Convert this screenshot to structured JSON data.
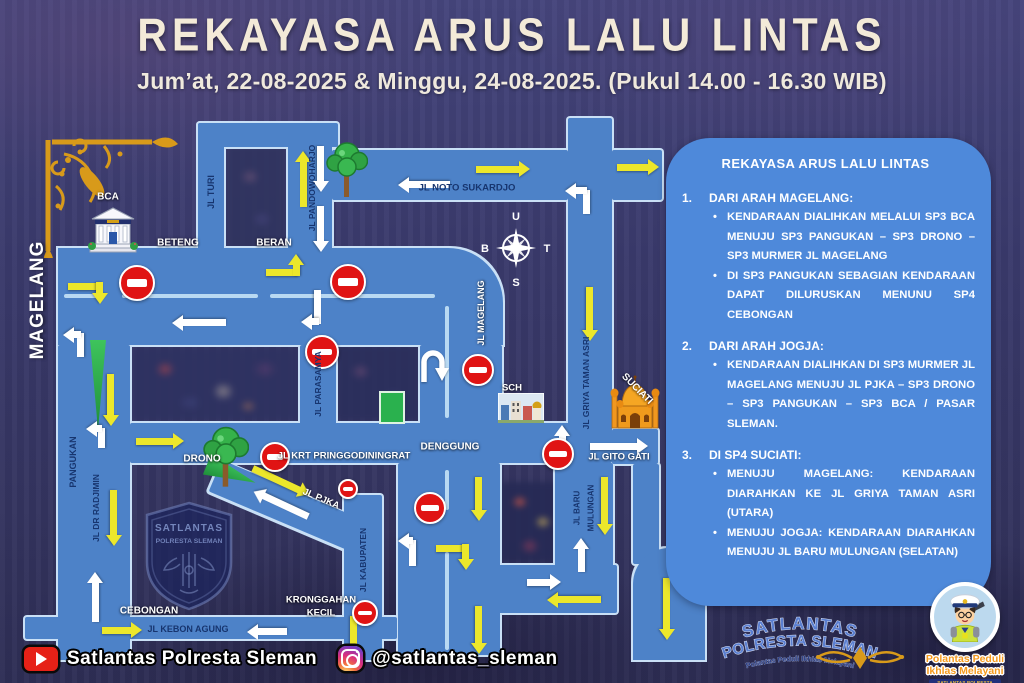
{
  "header": {
    "title": "REKAYASA ARUS LALU LINTAS",
    "subtitle": "Jum’at, 22-08-2025 & Minggu, 24-08-2025. (Pukul 14.00 - 16.30 WIB)"
  },
  "panel": {
    "title": "REKAYASA ARUS LALU LINTAS",
    "sections": [
      {
        "number": "1.",
        "heading": "DARI ARAH MAGELANG:",
        "bullets": [
          "KENDARAAN DIALIHKAN MELALUI SP3 BCA MENUJU SP3 PANGUKAN – SP3 DRONO – SP3 MURMER JL MAGELANG",
          "DI SP3 PANGUKAN SEBAGIAN KENDARAAN DAPAT DILURUSKAN MENUNU SP4 CEBONGAN"
        ]
      },
      {
        "number": "2.",
        "heading": "DARI ARAH JOGJA:",
        "bullets": [
          "KENDARAAN DIALIHKAN DI SP3 MURMER JL MAGELANG MENUJU JL PJKA – SP3 DRONO – SP3 PANGUKAN – SP3 BCA / PASAR SLEMAN."
        ]
      },
      {
        "number": "3.",
        "heading": "DI SP4 SUCIATI:",
        "bullets": [
          "MENUJU MAGELANG: KENDARAAN DIARAHKAN KE JL GRIYA TAMAN ASRI (UTARA)",
          "MENUJU JOGJA: KENDARAAN DIARAHKAN MENUJU JL BARU MULUNGAN (SELATAN)"
        ]
      }
    ]
  },
  "footer": {
    "youtube_label": "Satlantas Polresta Sleman",
    "instagram_label": "@satlantas_sleman"
  },
  "logos": {
    "arc_line1": "SATLANTAS",
    "arc_line2": "POLRESTA SLEMAN",
    "arc_tagline": "Polantas Peduli Ikhlas Melayani",
    "mascot_line1": "Polantas Peduli",
    "mascot_line2": "Ikhlas Melayani",
    "mascot_ribbon": "SATLANTAS POLRESTA SLEMAN"
  },
  "watermark": {
    "line1": "SATLANTAS",
    "line2": "POLRESTA SLEMAN"
  },
  "colors": {
    "road": "#4d82c8",
    "road_outline": "#c9e0f6",
    "panel": "#4e89da",
    "arrow_yellow": "#ece72b",
    "arrow_white": "#ffffff",
    "no_entry_red": "#e01414",
    "title_cream": "#f3ead8",
    "gold": "#d89a1a"
  },
  "compass": {
    "north": "U",
    "east": "T",
    "south": "S",
    "west": "B"
  },
  "map": {
    "landmarks": [
      "gold-corner-ornament",
      "bca-bank-building",
      "tree",
      "compass-rose",
      "school-building",
      "suciati-mosque",
      "satlantas-shield-watermark",
      "u-turn-arrow",
      "green-median-wedge",
      "green-field"
    ],
    "roads": [
      {
        "x": 198,
        "y": 123,
        "w": 140,
        "h": 24
      },
      {
        "x": 198,
        "y": 123,
        "w": 26,
        "h": 132
      },
      {
        "x": 288,
        "y": 123,
        "w": 44,
        "h": 130
      },
      {
        "x": 332,
        "y": 150,
        "w": 236,
        "h": 50
      },
      {
        "x": 612,
        "y": 150,
        "w": 50,
        "h": 50
      },
      {
        "x": 568,
        "y": 118,
        "w": 44,
        "h": 315
      },
      {
        "x": 58,
        "y": 248,
        "w": 445,
        "h": 97,
        "br": "0 55px 0 0"
      },
      {
        "x": 58,
        "y": 345,
        "w": 72,
        "h": 315
      },
      {
        "x": 130,
        "y": 423,
        "w": 482,
        "h": 40
      },
      {
        "x": 300,
        "y": 345,
        "w": 36,
        "h": 80
      },
      {
        "x": 420,
        "y": 345,
        "w": 82,
        "h": 80
      },
      {
        "x": 398,
        "y": 463,
        "w": 102,
        "h": 192
      },
      {
        "x": 222,
        "y": 460,
        "w": 168,
        "h": 34,
        "r": 23
      },
      {
        "x": 344,
        "y": 495,
        "w": 38,
        "h": 165
      },
      {
        "x": 555,
        "y": 463,
        "w": 58,
        "h": 114
      },
      {
        "x": 484,
        "y": 565,
        "w": 133,
        "h": 48
      },
      {
        "x": 612,
        "y": 429,
        "w": 46,
        "h": 35
      },
      {
        "x": 633,
        "y": 464,
        "w": 26,
        "h": 100
      },
      {
        "x": 633,
        "y": 548,
        "w": 72,
        "h": 112,
        "br": "36px 36px 0 0"
      },
      {
        "x": 25,
        "y": 617,
        "w": 372,
        "h": 22
      }
    ],
    "dividers": [
      {
        "x": 64,
        "y": 294,
        "l": 34,
        "o": "h"
      },
      {
        "x": 122,
        "y": 294,
        "l": 136,
        "o": "h"
      },
      {
        "x": 270,
        "y": 294,
        "l": 165,
        "o": "h"
      },
      {
        "x": 445,
        "y": 306,
        "l": 112,
        "o": "v"
      },
      {
        "x": 445,
        "y": 470,
        "l": 40,
        "o": "v"
      },
      {
        "x": 445,
        "y": 552,
        "l": 98,
        "o": "v"
      }
    ],
    "no_entry_signs": [
      {
        "x": 135,
        "y": 281,
        "r": 16
      },
      {
        "x": 346,
        "y": 280,
        "r": 16
      },
      {
        "x": 320,
        "y": 350,
        "r": 15
      },
      {
        "x": 476,
        "y": 368,
        "r": 14
      },
      {
        "x": 556,
        "y": 452,
        "r": 14
      },
      {
        "x": 273,
        "y": 455,
        "r": 13
      },
      {
        "x": 346,
        "y": 487,
        "r": 8
      },
      {
        "x": 428,
        "y": 506,
        "r": 14
      },
      {
        "x": 363,
        "y": 611,
        "r": 11
      }
    ],
    "arrows": [
      {
        "x": 303,
        "y": 207,
        "l": 56,
        "a": -90,
        "c": "y"
      },
      {
        "x": 476,
        "y": 169,
        "l": 54,
        "a": 0,
        "c": "y"
      },
      {
        "x": 617,
        "y": 167,
        "l": 42,
        "a": 0,
        "c": "y"
      },
      {
        "x": 590,
        "y": 287,
        "l": 54,
        "a": 90,
        "c": "y"
      },
      {
        "x": 111,
        "y": 374,
        "l": 52,
        "a": 90,
        "c": "y"
      },
      {
        "x": 114,
        "y": 490,
        "l": 56,
        "a": 90,
        "c": "y"
      },
      {
        "x": 136,
        "y": 441,
        "l": 48,
        "a": 0,
        "c": "y"
      },
      {
        "x": 253,
        "y": 468,
        "l": 62,
        "a": 25,
        "c": "y"
      },
      {
        "x": 102,
        "y": 630,
        "l": 40,
        "a": 0,
        "c": "y"
      },
      {
        "x": 354,
        "y": 616,
        "l": 42,
        "a": 90,
        "c": "y"
      },
      {
        "x": 479,
        "y": 477,
        "l": 44,
        "a": 90,
        "c": "y"
      },
      {
        "x": 479,
        "y": 606,
        "l": 48,
        "a": 90,
        "c": "y"
      },
      {
        "x": 601,
        "y": 600,
        "l": 54,
        "a": 180,
        "c": "y"
      },
      {
        "x": 605,
        "y": 477,
        "l": 58,
        "a": 90,
        "c": "y"
      },
      {
        "x": 667,
        "y": 578,
        "l": 62,
        "a": 90,
        "c": "y"
      },
      {
        "x": 436,
        "y": 548,
        "l": 32,
        "a": 0,
        "c": "y",
        "h": false
      },
      {
        "x": 466,
        "y": 544,
        "l": 26,
        "a": 90,
        "c": "y"
      },
      {
        "x": 68,
        "y": 286,
        "l": 34,
        "a": 0,
        "c": "y",
        "h": false
      },
      {
        "x": 100,
        "y": 282,
        "l": 22,
        "a": 90,
        "c": "y"
      },
      {
        "x": 266,
        "y": 272,
        "l": 32,
        "a": 0,
        "c": "y",
        "h": false
      },
      {
        "x": 296,
        "y": 276,
        "l": 22,
        "a": -90,
        "c": "y"
      },
      {
        "x": 321,
        "y": 146,
        "l": 46,
        "a": 90,
        "c": "w"
      },
      {
        "x": 321,
        "y": 206,
        "l": 46,
        "a": 90,
        "c": "w"
      },
      {
        "x": 450,
        "y": 185,
        "l": 52,
        "a": 180,
        "c": "w"
      },
      {
        "x": 226,
        "y": 323,
        "l": 54,
        "a": 180,
        "c": "w"
      },
      {
        "x": 95,
        "y": 622,
        "l": 50,
        "a": -90,
        "c": "w"
      },
      {
        "x": 308,
        "y": 517,
        "l": 60,
        "a": 205,
        "c": "w"
      },
      {
        "x": 287,
        "y": 632,
        "l": 40,
        "a": 180,
        "c": "w"
      },
      {
        "x": 527,
        "y": 582,
        "l": 34,
        "a": 0,
        "c": "w"
      },
      {
        "x": 581,
        "y": 572,
        "l": 34,
        "a": -90,
        "c": "w"
      },
      {
        "x": 590,
        "y": 446,
        "l": 58,
        "a": 0,
        "c": "w"
      },
      {
        "x": 562,
        "y": 447,
        "l": 22,
        "a": -90,
        "c": "w"
      },
      {
        "x": 562,
        "y": 445,
        "l": 22,
        "a": 90,
        "c": "w"
      },
      {
        "x": 586,
        "y": 214,
        "l": 24,
        "a": -90,
        "c": "w",
        "h": false
      },
      {
        "x": 587,
        "y": 191,
        "l": 22,
        "a": 180,
        "c": "w"
      },
      {
        "x": 318,
        "y": 290,
        "l": 34,
        "a": 90,
        "c": "w",
        "h": false
      },
      {
        "x": 319,
        "y": 322,
        "l": 18,
        "a": 180,
        "c": "w"
      },
      {
        "x": 80,
        "y": 357,
        "l": 24,
        "a": -90,
        "c": "w",
        "h": false
      },
      {
        "x": 81,
        "y": 335,
        "l": 18,
        "a": 180,
        "c": "w"
      },
      {
        "x": 101,
        "y": 448,
        "l": 20,
        "a": -90,
        "c": "w",
        "h": false
      },
      {
        "x": 102,
        "y": 429,
        "l": 16,
        "a": 180,
        "c": "w"
      },
      {
        "x": 412,
        "y": 566,
        "l": 26,
        "a": -90,
        "c": "w",
        "h": false
      },
      {
        "x": 413,
        "y": 541,
        "l": 15,
        "a": 180,
        "c": "w"
      }
    ],
    "labels": [
      {
        "t": "BCA",
        "x": 108,
        "y": 197,
        "r": 0,
        "c": "w",
        "s": 10
      },
      {
        "t": "BETENG",
        "x": 178,
        "y": 243,
        "r": 0,
        "c": "w",
        "s": 10
      },
      {
        "t": "BERAN",
        "x": 274,
        "y": 243,
        "r": 0,
        "c": "w",
        "s": 10
      },
      {
        "t": "MAGELANG",
        "x": 38,
        "y": 300,
        "r": -90,
        "c": "big",
        "s": 19
      },
      {
        "t": "JL TURI",
        "x": 211,
        "y": 192,
        "r": -90,
        "c": "n",
        "s": 9
      },
      {
        "t": "JL PANDOWOHARJO",
        "x": 312,
        "y": 188,
        "r": -90,
        "c": "n",
        "s": 8.5
      },
      {
        "t": "JL NOTO SUKARDJO",
        "x": 467,
        "y": 188,
        "r": 0,
        "c": "n",
        "s": 9.5
      },
      {
        "t": "JL MAGELANG",
        "x": 481,
        "y": 313,
        "r": -90,
        "c": "w",
        "s": 9
      },
      {
        "t": "JL PARASAMYA",
        "x": 318,
        "y": 384,
        "r": -90,
        "c": "n",
        "s": 8.5
      },
      {
        "t": "PANGUKAN",
        "x": 73,
        "y": 462,
        "r": -90,
        "c": "n",
        "s": 9
      },
      {
        "t": "JL DR RADJIMIN",
        "x": 96,
        "y": 508,
        "r": -90,
        "c": "n",
        "s": 8.5
      },
      {
        "t": "DRONO",
        "x": 202,
        "y": 459,
        "r": 0,
        "c": "w",
        "s": 10
      },
      {
        "t": "JL KRT PRINGGODININGRAT",
        "x": 344,
        "y": 456,
        "r": 0,
        "c": "w",
        "s": 9.5
      },
      {
        "t": "DENGGUNG",
        "x": 450,
        "y": 447,
        "r": 0,
        "c": "w",
        "s": 10
      },
      {
        "t": "SCH",
        "x": 512,
        "y": 388,
        "r": 0,
        "c": "w",
        "s": 9.5
      },
      {
        "t": "SUCIATI",
        "x": 637,
        "y": 389,
        "r": 45,
        "c": "w",
        "s": 10
      },
      {
        "t": "JL GRIYA TAMAN ASRI",
        "x": 586,
        "y": 383,
        "r": -90,
        "c": "n",
        "s": 8.5
      },
      {
        "t": "JL GITO GATI",
        "x": 619,
        "y": 457,
        "r": 0,
        "c": "w",
        "s": 9.5
      },
      {
        "t": "JL PJKA",
        "x": 321,
        "y": 499,
        "r": 23,
        "c": "w",
        "s": 9.5
      },
      {
        "t": "JL KABUPATEN",
        "x": 363,
        "y": 560,
        "r": -90,
        "c": "n",
        "s": 8.5
      },
      {
        "t": "JL BARU",
        "x": 577,
        "y": 508,
        "r": -90,
        "c": "n",
        "s": 8
      },
      {
        "t": "MULUNGAN",
        "x": 591,
        "y": 508,
        "r": -90,
        "c": "n",
        "s": 8
      },
      {
        "t": "KRONGGAHAN",
        "x": 321,
        "y": 600,
        "r": 0,
        "c": "w",
        "s": 9.5
      },
      {
        "t": "KECIL",
        "x": 321,
        "y": 613,
        "r": 0,
        "c": "w",
        "s": 9.5
      },
      {
        "t": "CEBONGAN",
        "x": 149,
        "y": 611,
        "r": 0,
        "c": "w",
        "s": 10
      },
      {
        "t": "JL KEBON AGUNG",
        "x": 188,
        "y": 629,
        "r": 0,
        "c": "n",
        "s": 9
      }
    ]
  }
}
